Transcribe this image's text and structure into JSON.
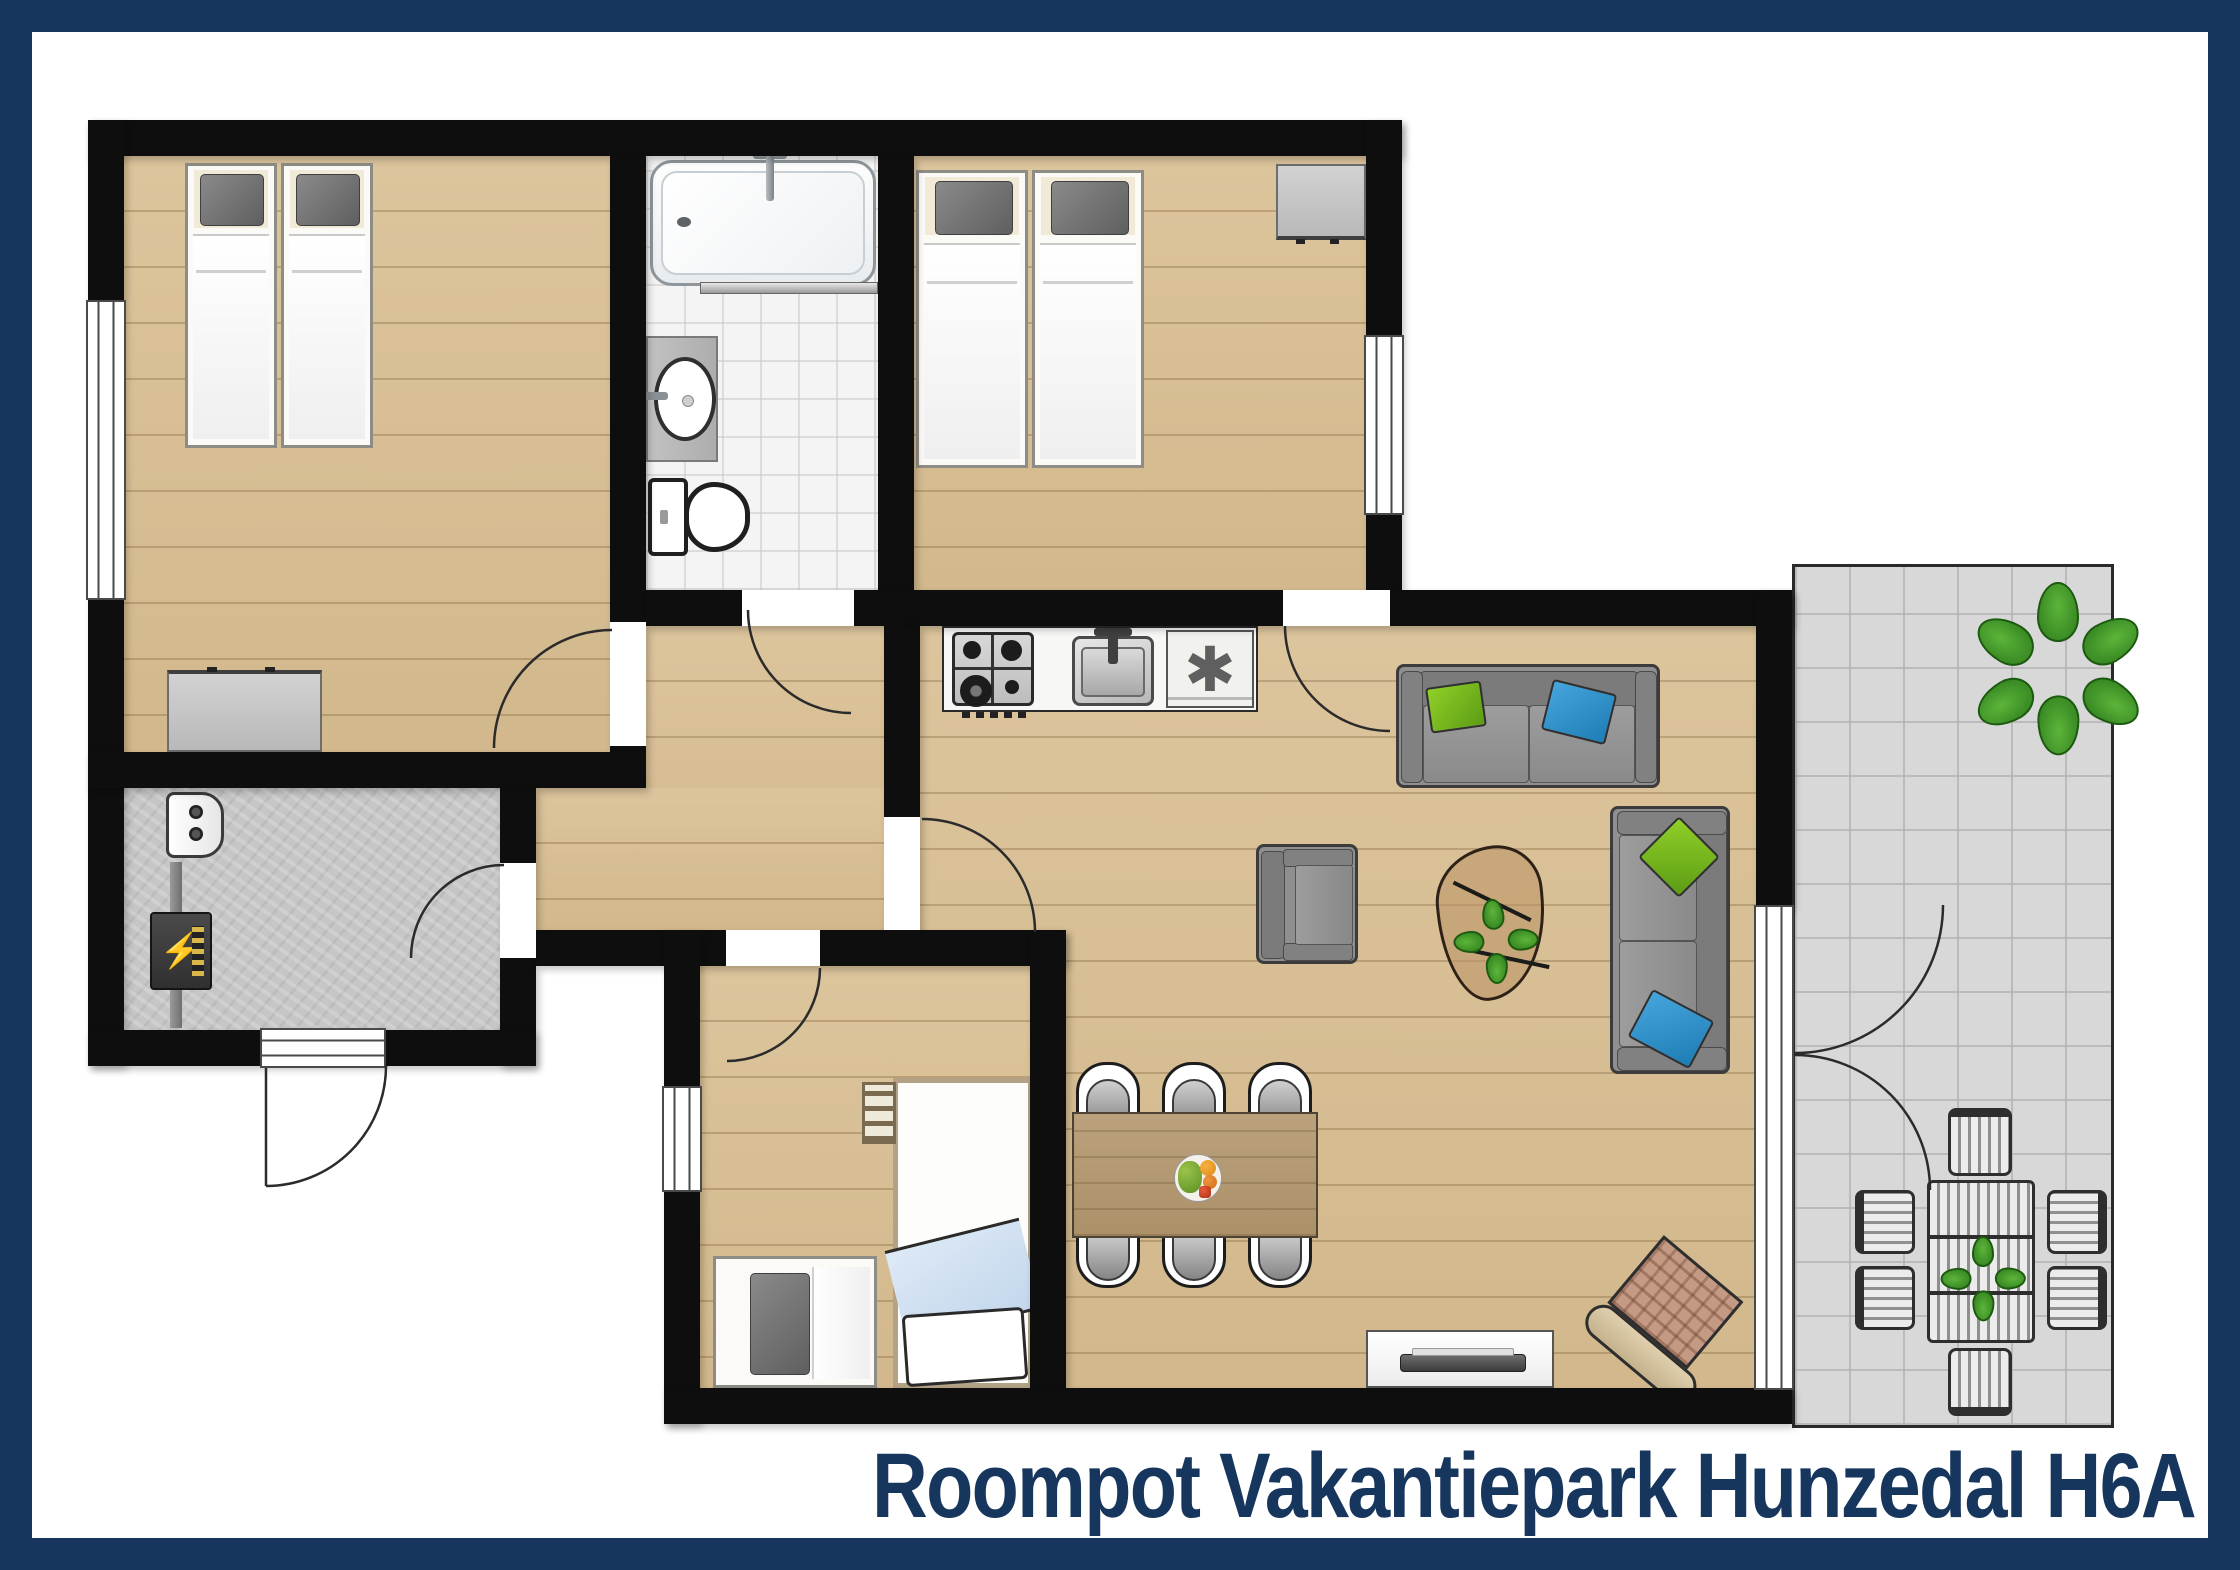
{
  "title": {
    "text": "Roompot Vakantiepark Hunzedal H6A"
  },
  "symbols": {
    "freezer_star": "✱",
    "electric_bolt": "⚡"
  },
  "palette": {
    "frame_navy": "#17365d",
    "wall_black": "#0e0e0e",
    "wood_floor": "#d8c097",
    "bath_tile": "#f4f4f4",
    "concrete_floor": "#c6c6c6",
    "terrace_tile": "#d8d8d8",
    "sofa_gray": "#8f8f8f",
    "cushion_green": "#79bc27",
    "cushion_blue": "#2e93cf",
    "dining_wood": "#b59a72",
    "plant_green": "#3f9b28",
    "title_text": "#17365d"
  },
  "floorplan": {
    "rooms": [
      {
        "name": "bedroom-1",
        "floor": "wood",
        "contents": [
          "twin-bed",
          "twin-bed",
          "dresser",
          "window-west",
          "door-to-hall"
        ]
      },
      {
        "name": "bathroom",
        "floor": "tile",
        "contents": [
          "bathtub",
          "washbasin",
          "toilet",
          "door-to-hall"
        ]
      },
      {
        "name": "bedroom-2",
        "floor": "wood",
        "contents": [
          "twin-bed",
          "twin-bed",
          "cabinet",
          "window-east",
          "door-to-living"
        ]
      },
      {
        "name": "hallway",
        "floor": "wood",
        "contents": [
          "door-to-living",
          "door-to-utility",
          "door-to-bedroom-3"
        ]
      },
      {
        "name": "utility-room",
        "floor": "concrete",
        "contents": [
          "boiler",
          "electrical-panel",
          "entrance-door"
        ]
      },
      {
        "name": "bedroom-3",
        "floor": "wood",
        "contents": [
          "single-bed-with-ladder",
          "side-bed",
          "window-west",
          "door-to-hall"
        ]
      },
      {
        "name": "living-kitchen",
        "floor": "wood",
        "contents": [
          "gas-hob",
          "kitchen-sink",
          "fridge-freezer",
          "sofa-horizontal",
          "sofa-vertical",
          "armchair",
          "coffee-table-with-plant",
          "dining-table-with-fruit-bowl",
          "six-dining-chairs",
          "tv-sideboard",
          "wicker-chair",
          "french-doors-to-terrace"
        ]
      },
      {
        "name": "terrace",
        "floor": "tiles",
        "contents": [
          "potted-plant",
          "garden-table-with-plant",
          "six-garden-chairs"
        ]
      }
    ]
  }
}
